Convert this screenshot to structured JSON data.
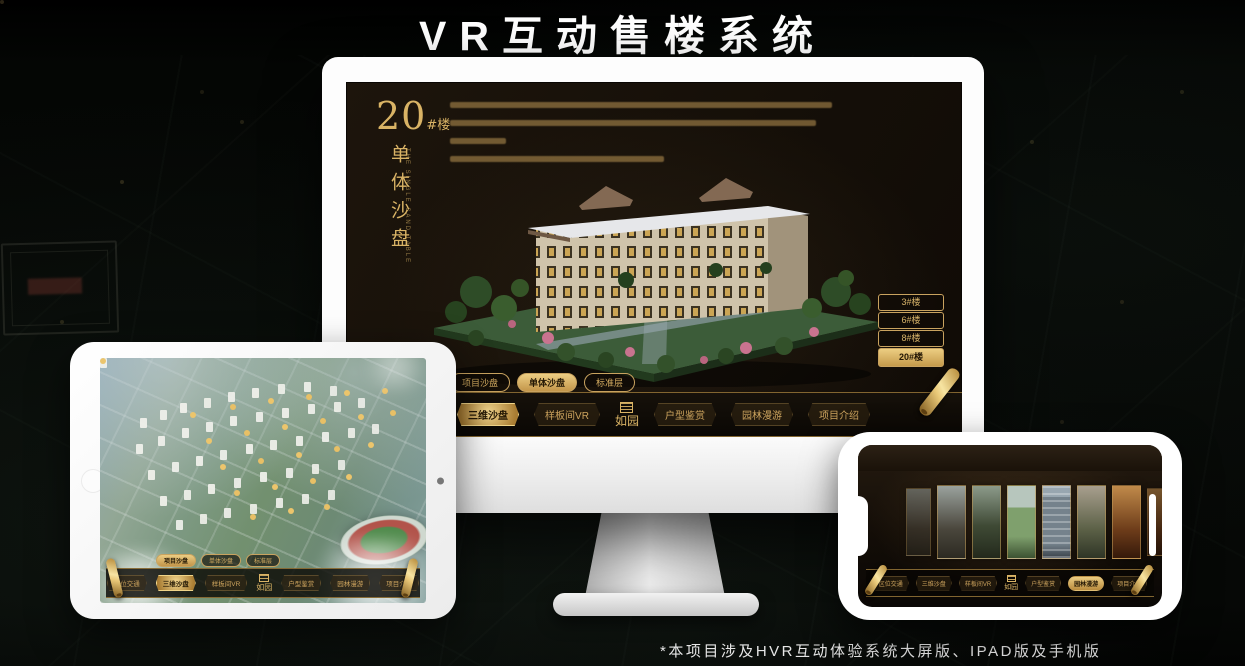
{
  "page": {
    "title": "VR互动售楼系统",
    "footnote": "*本项目涉及HVR互动体验系统大屏版、IPAD版及手机版"
  },
  "colors": {
    "gold": "#d2ab64",
    "gold_bright": "#ecca7e",
    "screen_bg": "#16100a",
    "white": "#ffffff"
  },
  "monitor": {
    "heading_number": "20",
    "heading_suffix": "#楼",
    "heading_vertical": "单体沙盘",
    "heading_caption": "THE SINGLE SAND TABLE",
    "floor_buttons": [
      {
        "label": "3#楼",
        "active": false
      },
      {
        "label": "6#楼",
        "active": false
      },
      {
        "label": "8#楼",
        "active": false
      },
      {
        "label": "20#楼",
        "active": true
      }
    ],
    "sub_tabs": [
      {
        "label": "项目沙盘",
        "active": false
      },
      {
        "label": "单体沙盘",
        "active": true
      },
      {
        "label": "标准层",
        "active": false
      }
    ],
    "nav": {
      "logo": "如园",
      "items": [
        {
          "label": "区位交通",
          "active": false
        },
        {
          "label": "三维沙盘",
          "active": true
        },
        {
          "label": "样板间VR",
          "active": false
        },
        {
          "label": "户型鉴赏",
          "active": false
        },
        {
          "label": "园林漫游",
          "active": false
        },
        {
          "label": "项目介绍",
          "active": false
        }
      ]
    }
  },
  "tablet": {
    "sub_tabs": [
      {
        "label": "项目沙盘",
        "active": true
      },
      {
        "label": "单体沙盘",
        "active": false
      },
      {
        "label": "标准层",
        "active": false
      }
    ],
    "nav": {
      "logo": "如园",
      "items": [
        {
          "label": "区位交通",
          "active": false
        },
        {
          "label": "三维沙盘",
          "active": true
        },
        {
          "label": "样板间VR",
          "active": false
        },
        {
          "label": "户型鉴赏",
          "active": false
        },
        {
          "label": "园林漫游",
          "active": false
        },
        {
          "label": "项目介绍",
          "active": false
        }
      ]
    }
  },
  "phone": {
    "nav": {
      "logo": "如园",
      "items": [
        {
          "label": "区位交通",
          "active": false
        },
        {
          "label": "三维沙盘",
          "active": false
        },
        {
          "label": "样板间VR",
          "active": false
        },
        {
          "label": "户型鉴赏",
          "active": false
        },
        {
          "label": "园林漫游",
          "active": true
        },
        {
          "label": "项目介绍",
          "active": false
        }
      ]
    }
  }
}
